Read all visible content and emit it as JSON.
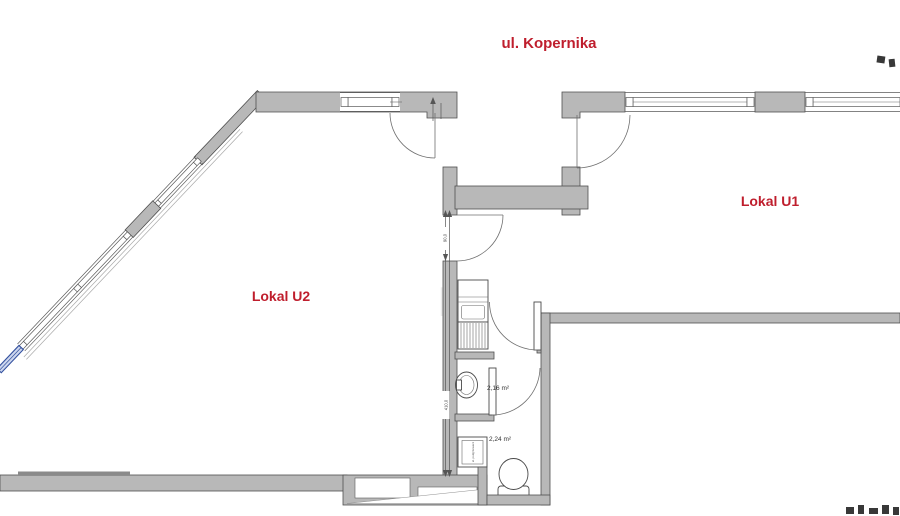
{
  "title": {
    "street": "ul. Kopernika"
  },
  "units": [
    {
      "label": "Lokal U1"
    },
    {
      "label": "Lokal U2"
    }
  ],
  "rooms": [
    {
      "area": "2,16 m²"
    },
    {
      "area": "2,24 m²"
    }
  ],
  "dimensions": {
    "door_width": "90,0",
    "corridor_length": "410,0"
  },
  "fixtures": {
    "heater_label": "el. podgrzewacz"
  },
  "colors": {
    "wall_gray": "#b8b8b8",
    "accent_red": "#bf1e2d",
    "window_blue": "#33509e"
  }
}
